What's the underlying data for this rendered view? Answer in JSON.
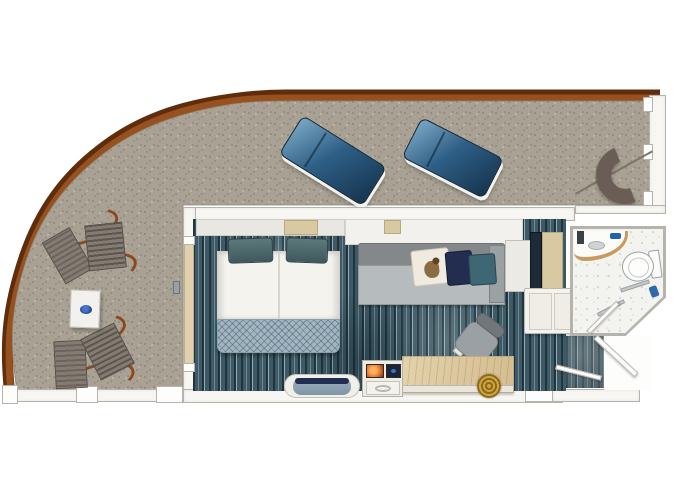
{
  "scene": {
    "type": "floor-plan",
    "subject": "cruise-ship balcony stateroom, top-down view",
    "areas": [
      "wrap-around balcony",
      "stateroom",
      "bathroom",
      "entry corridor"
    ]
  },
  "furniture": {
    "balcony": [
      "sun lounger",
      "sun lounger",
      "crescent lounge chair",
      "folding deck chair",
      "folding deck chair",
      "square side table with blue plate"
    ],
    "stateroom": [
      "double bed with two teal pillows and patterned runner",
      "grey sofa with duck, navy and teal cushions",
      "desk with gold coil object",
      "desk chair",
      "minibar / TV cabinet",
      "bench loveseat",
      "double-door wardrobe",
      "tall cabinet column",
      "balcony sliding door"
    ],
    "bathroom": [
      "curved vanity with sink",
      "toilet",
      "shower with glass door and grab bars"
    ],
    "entry": [
      "entry door swing",
      "inner door swing"
    ]
  },
  "palette": {
    "bg": "#ffffff",
    "rail_dark": "#5f2d0c",
    "rail_mid": "#96511f",
    "balcony_floor": "#a9a294",
    "speck_dark": "#847d70",
    "speck_mid": "#968f81",
    "speck_light": "#c6c0b2",
    "wall_fill": "#f7f6f2",
    "wall_line": "#b5b3ab",
    "lounger_deep": "#16344f",
    "lounger_mid": "#2e5f86",
    "lounger_light": "#7aa7c4",
    "carpet_dark": "#22343c",
    "carpet_mid": "#3d5a66",
    "carpet_light": "#6e8894",
    "carpet_pale": "#97aab1",
    "sheet": "#f5f3ee",
    "blanket": "#a3b5c0",
    "blanket_line": "#5f7c8c",
    "pillow_teal": "#4e6a6e",
    "pillow_edge": "#2f4448",
    "sofa_back": "#85888b",
    "sofa_seat": "#b6bbbe",
    "pillow_navy": "#232d4f",
    "pillow_sea": "#3e6673",
    "pillow_duck": "#f0ebe0",
    "desk_tan": "#d9c49c",
    "desk_grain": "#b08d52",
    "gold": "#d1a43c",
    "navy_cabinet": "#1e2a38",
    "tan_cabinet": "#d8c9a2",
    "bath_floor": "#f3f3f0",
    "bath_speck": "#d9d9d4",
    "fixture_line": "#9aa0a4",
    "vanity_wood": "#c79a5d",
    "chair_fabric": "#847b72",
    "chair_fabric_dark": "#6b635c",
    "chair_wood": "#8a4a1f",
    "plate_blue": "#2a4fa0",
    "crescent": "#6a5d55",
    "steel": "#c4c9cc"
  }
}
